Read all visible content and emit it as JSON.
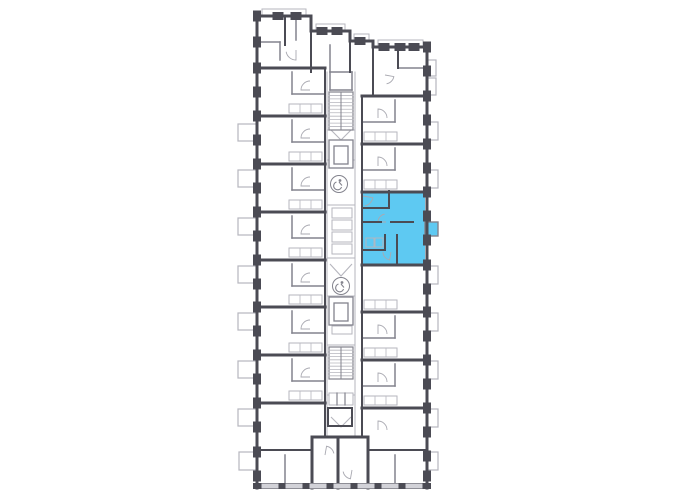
{
  "plan": {
    "canvas": {
      "width": 680,
      "height": 500
    },
    "colors": {
      "bg": "#ffffff",
      "wall_dark": "#4b4b54",
      "wall_mid": "#83838d",
      "line_light": "#b6b6be",
      "arc": "#a9a9b1",
      "window_gap": "#d2d2d8",
      "highlight": "#5ec9f2",
      "highlight_stroke": "#4b4b54"
    },
    "highlight": {
      "polygon": "363,191 425,191 425,265 363,265",
      "balcony": [
        425,
        222,
        13,
        14
      ],
      "interior_walls": [
        [
          363,
          208,
          389,
          208,
          2
        ],
        [
          389,
          191,
          389,
          208,
          2
        ],
        [
          363,
          222,
          381,
          222,
          2
        ],
        [
          391,
          222,
          413,
          222,
          2
        ],
        [
          397,
          235,
          397,
          263,
          2
        ],
        [
          363,
          250,
          385,
          250,
          2
        ],
        [
          385,
          235,
          385,
          250,
          2
        ]
      ],
      "fixtures": [
        [
          366,
          238,
          8,
          9
        ],
        [
          375,
          238,
          8,
          9
        ]
      ]
    },
    "balconies": {
      "left": [
        [
          238,
          124,
          19,
          17
        ],
        [
          238,
          170,
          19,
          17
        ],
        [
          238,
          218,
          19,
          17
        ],
        [
          238,
          266,
          19,
          17
        ],
        [
          238,
          313,
          19,
          17
        ],
        [
          238,
          361,
          19,
          17
        ],
        [
          238,
          409,
          19,
          17
        ],
        [
          239,
          452,
          18,
          18
        ]
      ],
      "right": [
        [
          427,
          60,
          9,
          16
        ],
        [
          427,
          78,
          9,
          17
        ],
        [
          427,
          122,
          11,
          18
        ],
        [
          427,
          170,
          11,
          18
        ],
        [
          427,
          266,
          11,
          18
        ],
        [
          427,
          313,
          11,
          18
        ],
        [
          427,
          361,
          11,
          18
        ],
        [
          427,
          409,
          11,
          18
        ],
        [
          427,
          452,
          11,
          18
        ]
      ]
    },
    "parapets": [
      [
        262,
        9,
        44,
        7
      ],
      [
        316,
        24,
        29,
        7
      ],
      [
        354,
        34,
        15,
        7
      ],
      [
        378,
        40,
        45,
        7
      ]
    ],
    "walls_dark": [
      [
        256,
        16,
        311,
        16,
        3
      ],
      [
        311,
        16,
        311,
        31,
        3
      ],
      [
        311,
        31,
        350,
        31,
        3
      ],
      [
        350,
        31,
        350,
        41,
        3
      ],
      [
        350,
        41,
        373,
        41,
        3
      ],
      [
        373,
        41,
        373,
        47,
        3
      ],
      [
        373,
        47,
        428,
        47,
        3
      ],
      [
        257,
        15,
        257,
        488,
        3
      ],
      [
        427,
        46,
        427,
        488,
        3
      ],
      [
        256,
        486,
        428,
        486,
        6
      ],
      [
        312,
        437,
        312,
        488,
        3
      ],
      [
        338,
        437,
        338,
        488,
        3
      ],
      [
        368,
        437,
        368,
        488,
        3
      ],
      [
        312,
        437,
        368,
        437,
        3
      ],
      [
        257,
        68,
        325,
        68,
        3
      ],
      [
        257,
        116,
        325,
        116,
        3
      ],
      [
        257,
        164,
        325,
        164,
        3
      ],
      [
        257,
        212,
        325,
        212,
        3
      ],
      [
        257,
        260,
        325,
        260,
        3
      ],
      [
        257,
        307,
        325,
        307,
        3
      ],
      [
        257,
        355,
        325,
        355,
        3
      ],
      [
        257,
        403,
        325,
        403,
        3
      ],
      [
        325,
        68,
        325,
        437,
        2
      ],
      [
        362,
        96,
        427,
        96,
        3
      ],
      [
        362,
        144,
        427,
        144,
        3
      ],
      [
        362,
        192,
        427,
        192,
        3
      ],
      [
        362,
        265,
        427,
        265,
        3
      ],
      [
        362,
        312,
        427,
        312,
        3
      ],
      [
        362,
        360,
        427,
        360,
        3
      ],
      [
        362,
        408,
        427,
        408,
        3
      ],
      [
        362,
        96,
        362,
        437,
        2
      ],
      [
        285,
        16,
        285,
        45,
        2
      ],
      [
        311,
        31,
        311,
        72,
        2
      ],
      [
        350,
        41,
        350,
        72,
        2
      ],
      [
        373,
        47,
        373,
        96,
        2
      ],
      [
        398,
        47,
        398,
        68,
        2
      ],
      [
        257,
        450,
        312,
        450,
        2
      ],
      [
        368,
        450,
        427,
        450,
        2
      ],
      [
        328,
        408,
        352,
        408,
        2
      ],
      [
        328,
        408,
        328,
        426,
        2
      ],
      [
        352,
        408,
        352,
        426,
        2
      ],
      [
        328,
        426,
        352,
        426,
        2
      ]
    ],
    "walls_mid": [
      [
        398,
        68,
        427,
        68,
        1.5
      ],
      [
        257,
        42,
        280,
        42,
        1.5
      ],
      [
        280,
        42,
        280,
        60,
        1.5
      ],
      [
        296,
        16,
        296,
        40,
        1.5
      ],
      [
        330,
        45,
        330,
        72,
        1.5
      ],
      [
        292,
        72,
        292,
        94,
        1.5
      ],
      [
        292,
        94,
        325,
        94,
        1.5
      ],
      [
        292,
        120,
        292,
        142,
        1.5
      ],
      [
        292,
        142,
        325,
        142,
        1.5
      ],
      [
        292,
        168,
        292,
        190,
        1.5
      ],
      [
        292,
        190,
        325,
        190,
        1.5
      ],
      [
        292,
        216,
        292,
        238,
        1.5
      ],
      [
        292,
        238,
        325,
        238,
        1.5
      ],
      [
        292,
        264,
        292,
        286,
        1.5
      ],
      [
        292,
        286,
        325,
        286,
        1.5
      ],
      [
        292,
        311,
        292,
        333,
        1.5
      ],
      [
        292,
        333,
        325,
        333,
        1.5
      ],
      [
        292,
        359,
        292,
        381,
        1.5
      ],
      [
        292,
        381,
        325,
        381,
        1.5
      ],
      [
        395,
        100,
        395,
        122,
        1.5
      ],
      [
        362,
        122,
        395,
        122,
        1.5
      ],
      [
        395,
        148,
        395,
        170,
        1.5
      ],
      [
        362,
        170,
        395,
        170,
        1.5
      ],
      [
        395,
        316,
        395,
        338,
        1.5
      ],
      [
        362,
        338,
        395,
        338,
        1.5
      ],
      [
        395,
        364,
        395,
        386,
        1.5
      ],
      [
        362,
        386,
        395,
        386,
        1.5
      ],
      [
        285,
        455,
        285,
        487,
        1.5
      ],
      [
        395,
        455,
        395,
        487,
        1.5
      ],
      [
        330,
        72,
        352,
        72,
        1.5
      ],
      [
        330,
        72,
        330,
        90,
        1.5
      ],
      [
        352,
        72,
        352,
        90,
        1.5
      ],
      [
        330,
        90,
        352,
        90,
        1.5
      ],
      [
        337,
        393,
        337,
        405,
        1.2
      ],
      [
        345,
        393,
        345,
        405,
        1.2
      ]
    ],
    "lines_light": [
      [
        327,
        72,
        327,
        437,
        1
      ],
      [
        355,
        72,
        355,
        437,
        1
      ],
      [
        327,
        130,
        355,
        130,
        1
      ],
      [
        327,
        160,
        355,
        160,
        1
      ],
      [
        327,
        205,
        355,
        205,
        1
      ],
      [
        327,
        258,
        355,
        258,
        1
      ],
      [
        327,
        296,
        355,
        296,
        1
      ],
      [
        327,
        345,
        355,
        345,
        1
      ],
      [
        327,
        395,
        355,
        395,
        1
      ],
      [
        327,
        437,
        355,
        437,
        1
      ]
    ],
    "corridor_boxes": [
      [
        332,
        208,
        20,
        10
      ],
      [
        332,
        220,
        20,
        10
      ],
      [
        332,
        232,
        20,
        10
      ],
      [
        332,
        244,
        20,
        10
      ],
      [
        332,
        316,
        20,
        8
      ],
      [
        332,
        326,
        20,
        8
      ],
      [
        329,
        393,
        24,
        12
      ]
    ],
    "elevators": [
      [
        329,
        140,
        24,
        28
      ],
      [
        334,
        146,
        14,
        18
      ],
      [
        329,
        297,
        24,
        28
      ],
      [
        334,
        303,
        14,
        18
      ]
    ],
    "stairs": [
      {
        "x": 329,
        "y": 92,
        "w": 24,
        "h": 38,
        "treads": 11
      },
      {
        "x": 329,
        "y": 347,
        "w": 24,
        "h": 32,
        "treads": 10
      }
    ],
    "chevrons": [
      [
        329,
        128,
        341,
        140,
        353,
        128
      ],
      [
        330,
        264,
        341,
        276,
        352,
        264
      ],
      [
        331,
        417,
        341,
        427,
        351,
        417
      ]
    ],
    "access_icons": [
      {
        "cx": 339,
        "cy": 184,
        "r": 8.5
      },
      {
        "cx": 341,
        "cy": 286,
        "r": 8.5
      }
    ],
    "kitchens": {
      "left_x": 289,
      "right_x": 364,
      "w": 33,
      "h": 9,
      "left_ys": [
        104,
        152,
        200,
        248,
        295,
        343,
        391
      ],
      "right_ys": [
        132,
        180,
        300,
        348,
        396
      ]
    },
    "piers": {
      "left": {
        "x": 253.5,
        "w": 7,
        "h": 10,
        "ys": [
          16,
          42,
          68,
          92,
          116,
          140,
          164,
          188,
          212,
          236,
          260,
          284,
          307,
          331,
          355,
          379,
          403,
          427,
          452,
          476
        ]
      },
      "right": {
        "x": 423.5,
        "w": 7,
        "h": 10,
        "ys": [
          47,
          71,
          96,
          120,
          144,
          168,
          192,
          216,
          240,
          265,
          289,
          312,
          336,
          360,
          384,
          408,
          432,
          456,
          476
        ]
      },
      "top_rects": [
        [
          273,
          12.5,
          10,
          7
        ],
        [
          291,
          12.5,
          10,
          7
        ],
        [
          317,
          27.5,
          10,
          7
        ],
        [
          332,
          27.5,
          10,
          7
        ],
        [
          355,
          37.5,
          10,
          7
        ],
        [
          379,
          43.5,
          10,
          7
        ],
        [
          395,
          43.5,
          10,
          7
        ],
        [
          409,
          43.5,
          10,
          7
        ]
      ],
      "bottom_gaps": [
        [
          262,
          484,
          16,
          4
        ],
        [
          286,
          484,
          16,
          4
        ],
        [
          310,
          484,
          16,
          4
        ],
        [
          334,
          484,
          16,
          4
        ],
        [
          358,
          484,
          16,
          4
        ],
        [
          382,
          484,
          16,
          4
        ],
        [
          406,
          484,
          16,
          4
        ]
      ]
    },
    "door_arcs": [
      {
        "cx": 310,
        "cy": 90,
        "r": 9,
        "a0": 180,
        "a1": 270
      },
      {
        "cx": 310,
        "cy": 138,
        "r": 9,
        "a0": 180,
        "a1": 270
      },
      {
        "cx": 310,
        "cy": 186,
        "r": 9,
        "a0": 180,
        "a1": 270
      },
      {
        "cx": 310,
        "cy": 234,
        "r": 9,
        "a0": 180,
        "a1": 270
      },
      {
        "cx": 310,
        "cy": 282,
        "r": 9,
        "a0": 180,
        "a1": 270
      },
      {
        "cx": 310,
        "cy": 329,
        "r": 9,
        "a0": 180,
        "a1": 270
      },
      {
        "cx": 310,
        "cy": 377,
        "r": 9,
        "a0": 180,
        "a1": 270
      },
      {
        "cx": 378,
        "cy": 118,
        "r": 9,
        "a0": 270,
        "a1": 360
      },
      {
        "cx": 378,
        "cy": 166,
        "r": 9,
        "a0": 270,
        "a1": 360
      },
      {
        "cx": 378,
        "cy": 334,
        "r": 9,
        "a0": 270,
        "a1": 360
      },
      {
        "cx": 378,
        "cy": 382,
        "r": 9,
        "a0": 270,
        "a1": 360
      },
      {
        "cx": 378,
        "cy": 430,
        "r": 9,
        "a0": 270,
        "a1": 360
      },
      {
        "cx": 363,
        "cy": 196,
        "r": 10,
        "a0": 10,
        "a1": 80
      },
      {
        "cx": 386,
        "cy": 222,
        "r": 8,
        "a0": 180,
        "a1": 260
      },
      {
        "cx": 391,
        "cy": 252,
        "r": 8,
        "a0": 100,
        "a1": 180
      },
      {
        "cx": 296,
        "cy": 50,
        "r": 10,
        "a0": 90,
        "a1": 170
      },
      {
        "cx": 385,
        "cy": 75,
        "r": 9,
        "a0": 10,
        "a1": 80
      },
      {
        "cx": 325,
        "cy": 455,
        "r": 9,
        "a0": 280,
        "a1": 350
      },
      {
        "cx": 352,
        "cy": 470,
        "r": 9,
        "a0": 100,
        "a1": 170
      }
    ]
  }
}
